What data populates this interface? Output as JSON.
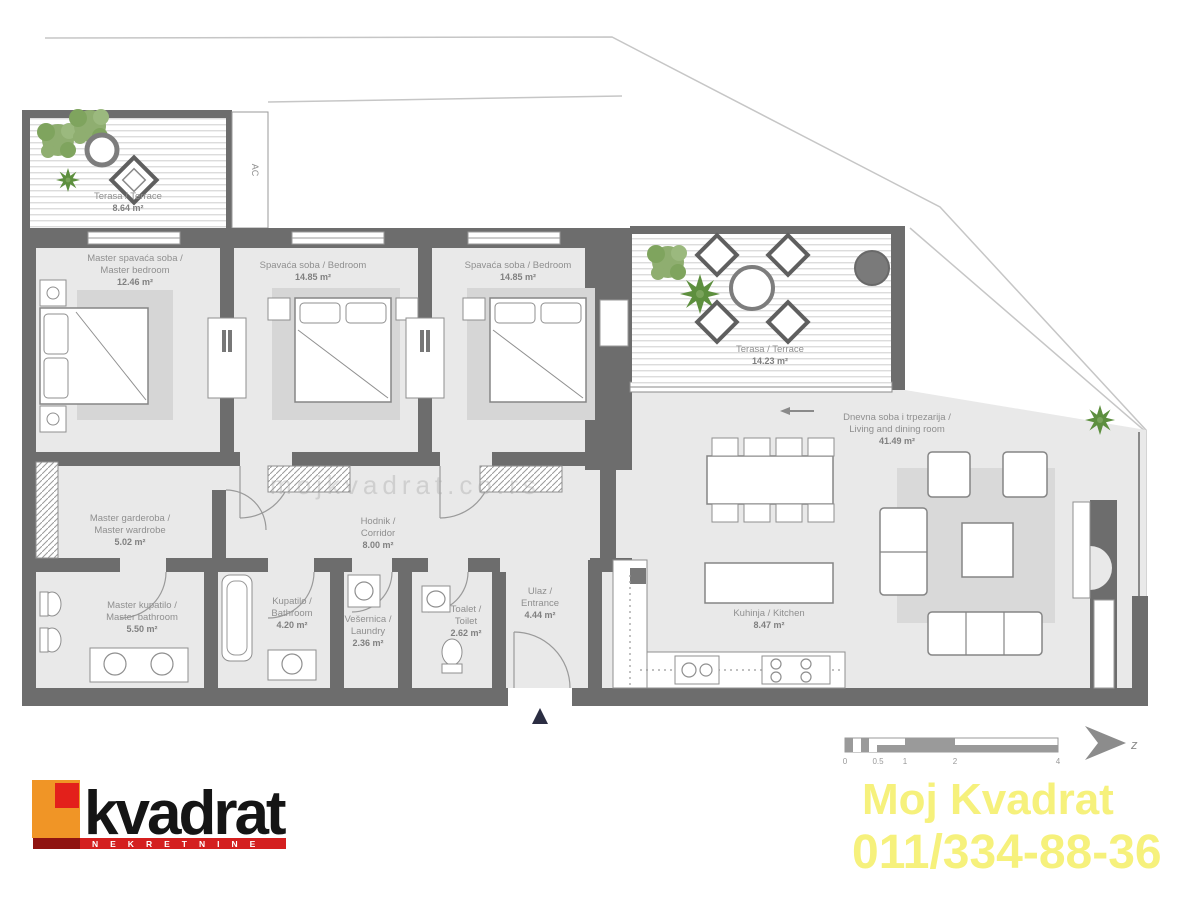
{
  "rooms": {
    "terrace_top": {
      "name": "Terasa / Terrace",
      "area": "8.64 m²"
    },
    "master_bedroom": {
      "line1": "Master spavaća soba /",
      "line2": "Master bedroom",
      "area": "12.46 m²"
    },
    "bedroom_2": {
      "line1": "Spavaća soba / Bedroom",
      "area": "14.85 m²"
    },
    "bedroom_3": {
      "line1": "Spavaća soba / Bedroom",
      "area": "14.85 m²"
    },
    "terrace_main": {
      "name": "Terasa / Terrace",
      "area": "14.23 m²"
    },
    "living_dining": {
      "line1": "Dnevna soba i trpezarija /",
      "line2": "Living and dining room",
      "area": "41.49 m²"
    },
    "master_wardrobe": {
      "line1": "Master garderoba /",
      "line2": "Master wardrobe",
      "area": "5.02 m²"
    },
    "corridor": {
      "line1": "Hodnik /",
      "line2": "Corridor",
      "area": "8.00 m²"
    },
    "master_bathroom": {
      "line1": "Master kupatilo /",
      "line2": "Master bathroom",
      "area": "5.50 m²"
    },
    "bathroom": {
      "line1": "Kupatilo /",
      "line2": "Bathroom",
      "area": "4.20 m²"
    },
    "laundry": {
      "line1": "Vešernica /",
      "line2": "Laundry",
      "area": "2.36 m²"
    },
    "toilet": {
      "line1": "Toalet /",
      "line2": "Toilet",
      "area": "2.62 m²"
    },
    "entrance": {
      "line1": "Ulaz /",
      "line2": "Entrance",
      "area": "4.44 m²"
    },
    "kitchen": {
      "line1": "Kuhinja / Kitchen",
      "area": "8.47 m²"
    }
  },
  "annotations": {
    "ac_label": "AC",
    "compass_letter": "z",
    "scale_ticks": [
      "0",
      "0.5",
      "1",
      "2",
      "4"
    ],
    "watermark": "mojkvadrat.co.rs"
  },
  "branding": {
    "logo_name": "kvadrat",
    "logo_tagline": "NEKRETNINE",
    "agency_name": "Moj Kvadrat",
    "agency_phone": "011/334-88-36"
  },
  "colors": {
    "wall_gray": "#6d6d6d",
    "floor_gray": "#e9e9e9",
    "logo_orange": "#f09526",
    "logo_red": "#da1f1b",
    "logo_bar_red": "#d41f1f",
    "contact_yellow": "#f6f17c",
    "plant_green": "#7fae62"
  }
}
